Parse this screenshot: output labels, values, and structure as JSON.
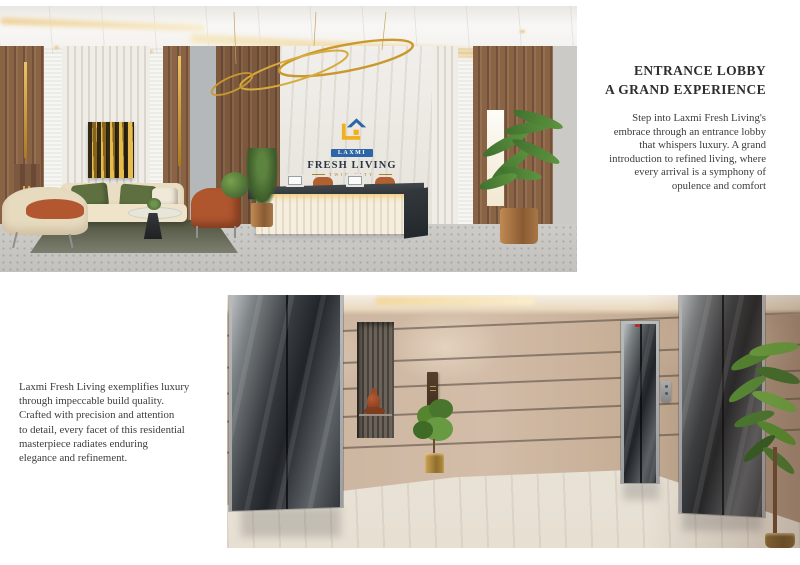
{
  "hero": {
    "title": "ENTRANCE LOBBY\nA GRAND EXPERIENCE",
    "body": "Step into Laxmi Fresh Living's\nembrace through an entrance lobby\nthat whispers luxury. A grand\nintroduction to refined living, where\nevery arrival is a symphony of\nopulence and comfort"
  },
  "quality": {
    "body": "Laxmi Fresh Living exemplifies luxury\nthrough impeccable build quality.\nCrafted with precision and attention\nto detail, every facet of this residential\nmasterpiece radiates enduring\nelegance and refinement."
  },
  "logo": {
    "brand": "LAXMI",
    "name": "FRESH LIVING",
    "tagline": "TWIN CITY"
  },
  "colors": {
    "accent_gold": "#c9992e",
    "wood": "#8a6244",
    "leather": "#b2572f",
    "pillow_green": "#5f7040",
    "marble_beige": "#c9b19b",
    "text": "#3c3c3c"
  }
}
